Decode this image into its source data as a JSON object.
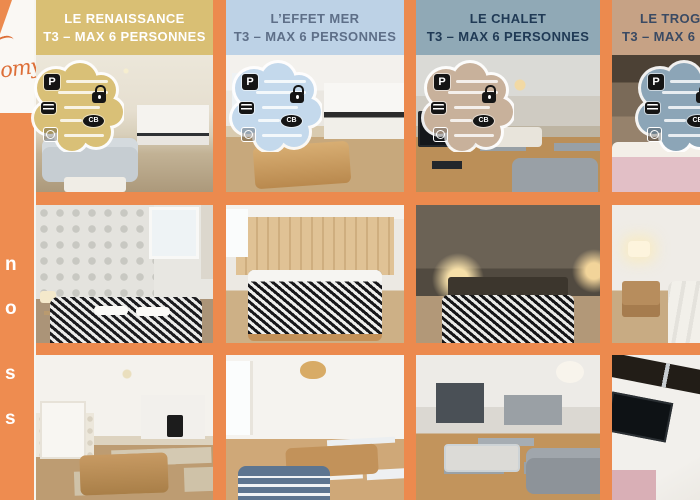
{
  "canvas": {
    "background_orange": "#ec8a4e",
    "divider_orange": "#ec8a4e",
    "gap_white": "#f7f5f0"
  },
  "sidebar": {
    "bg": "#ee8c50",
    "logo_fragment": "omy",
    "logo_color": "#dd6f38",
    "items": [
      {
        "fragment": "n"
      },
      {
        "fragment": "o"
      },
      {
        "fragment": "s"
      },
      {
        "fragment": "s"
      }
    ]
  },
  "columns": [
    {
      "id": "le-renaissance",
      "name": "LE RENAISSANCE",
      "subtitle": "T3 – MAX 6 PERSONNES",
      "header_bg": "#d9bf74",
      "header_fg": "#ffffff",
      "badge_bg": "#d9c077"
    },
    {
      "id": "l-effet-mer",
      "name": "L’EFFET MER",
      "subtitle": "T3 – MAX 6 PERSONNES",
      "header_bg": "#bdd2e6",
      "header_fg": "#5e6f88",
      "badge_bg": "#c4d9ec"
    },
    {
      "id": "le-chalet",
      "name": "LE CHALET",
      "subtitle": "T3 – MAX 6 PERSONNES",
      "header_bg": "#90a9b6",
      "header_fg": "#203a55",
      "badge_bg": "#c8b19b"
    },
    {
      "id": "le-trog",
      "name": "LE TROG",
      "subtitle": "T3 – MAX 6",
      "header_bg": "#c6a285",
      "header_fg": "#3a4a63",
      "badge_bg": "#8ca5b7"
    }
  ],
  "badge": {
    "parking_label": "P",
    "cb_label": "CB",
    "icons": [
      "parking",
      "keypad",
      "lock",
      "bank-card-cb",
      "washing-machine"
    ]
  }
}
